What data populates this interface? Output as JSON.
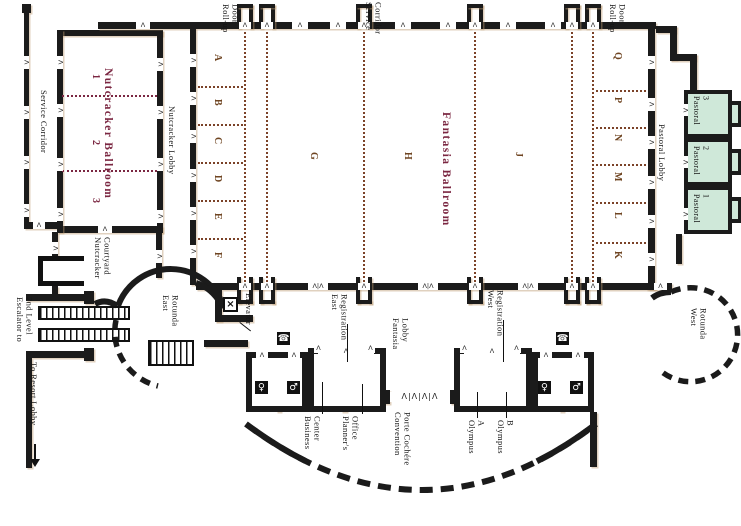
{
  "colors": {
    "wall": "#1b1b1b",
    "ballroom_title": "#7b2742",
    "section_letter": "#6f4522",
    "airwall_dots": "#7b4228",
    "pastoral_fill": "#cfe8d9",
    "olympus_divider": "#1f7a50"
  },
  "icons": {
    "elevator": "×",
    "telephone": "☎",
    "restroom_women": "♀",
    "restroom_men": "♂"
  },
  "corridors": {
    "service_left": "Service Corridor",
    "service_top": [
      "Service",
      "Corridor"
    ],
    "nutcracker_lobby": "Nutcracker Lobby",
    "pastoral_lobby": "Pastoral Lobby",
    "fantasia_lobby": [
      "Fantasia",
      "Lobby"
    ]
  },
  "rooms": {
    "nutcracker": {
      "title": "Nutcracker Ballroom",
      "sections": [
        "1",
        "2",
        "3"
      ]
    },
    "fantasia": {
      "title": "Fantasia Ballroom",
      "sections_left": [
        "A",
        "B",
        "C",
        "D",
        "E",
        "F"
      ],
      "sections_center": [
        "G",
        "H",
        "J"
      ],
      "sections_right": [
        "Q",
        "P",
        "N",
        "M",
        "L",
        "K"
      ]
    },
    "pastoral": [
      {
        "name": "Pastoral",
        "number": "3"
      },
      {
        "name": "Pastoral",
        "number": "2"
      },
      {
        "name": "Pastoral",
        "number": "1"
      }
    ],
    "olympus_a": [
      "Olympus",
      "A"
    ],
    "olympus_b": [
      "Olympus",
      "B"
    ],
    "business_center": [
      "Business",
      "Center"
    ],
    "planners_office": [
      "Planner's",
      "Office"
    ]
  },
  "areas": {
    "east_rotunda": [
      "East",
      "Rotunda"
    ],
    "west_rotunda": [
      "West",
      "Rotunda"
    ],
    "nutcracker_courtyard": [
      "Nutcracker",
      "Courtyard"
    ],
    "east_registration": [
      "East",
      "Registration"
    ],
    "west_registration": [
      "West",
      "Registration"
    ],
    "convention_porte_cochere": [
      "Convention",
      "Porte Cochére"
    ],
    "elevator": "Elevator",
    "escalator": [
      "Escalator to",
      "2nd Level"
    ],
    "to_resort_lobby": "To Resort Lobby",
    "rollup_door": [
      "Roll-up",
      "Door"
    ]
  }
}
